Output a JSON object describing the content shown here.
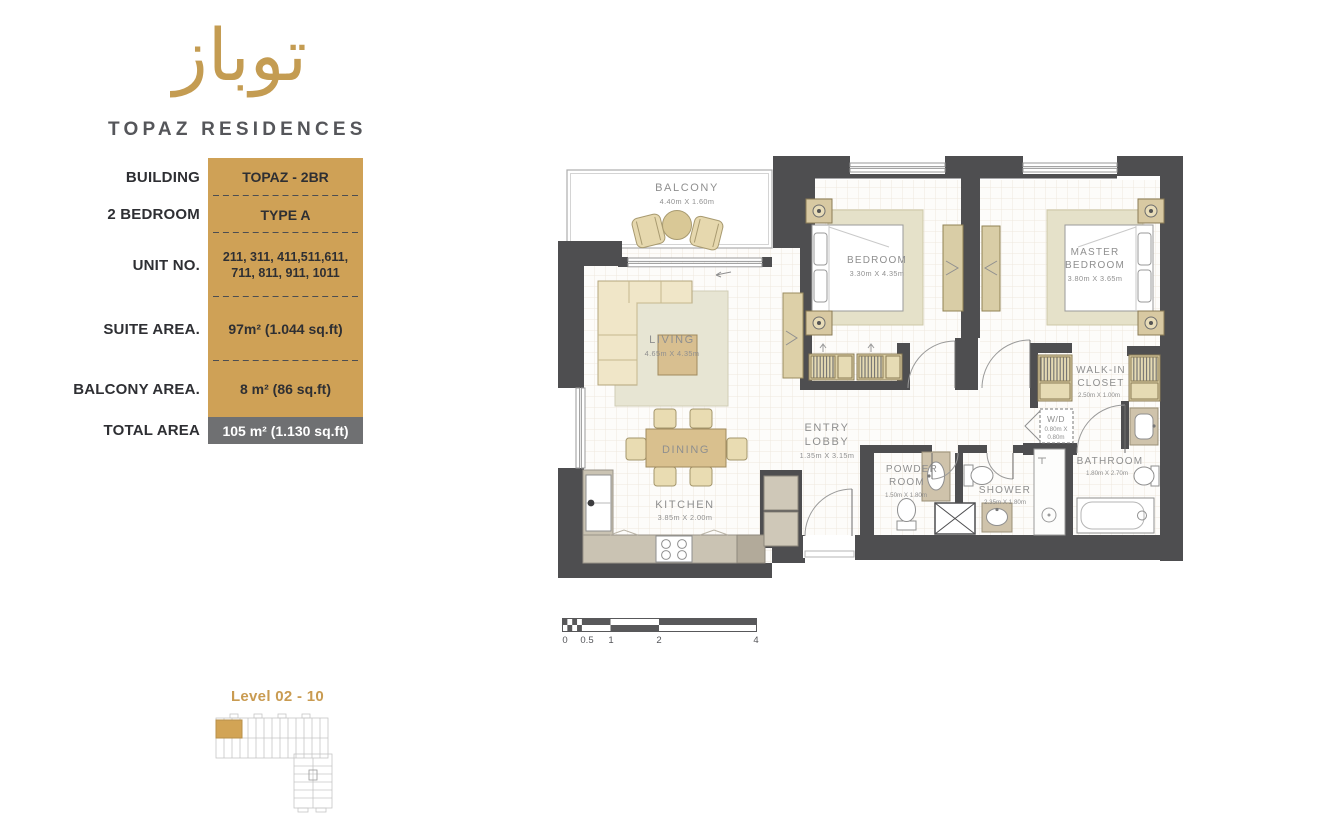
{
  "brand": {
    "logo_arabic": "توباز",
    "name": "TOPAZ RESIDENCES"
  },
  "specs": {
    "rows": [
      {
        "label": "BUILDING",
        "value": "TOPAZ - 2BR"
      },
      {
        "label": "2 BEDROOM",
        "value": "TYPE A"
      },
      {
        "label": "UNIT NO.",
        "value_lines": [
          "211, 311, 411,511,611,",
          "711, 811, 911, 1011"
        ]
      },
      {
        "label": "SUITE AREA.",
        "value": "97m² (1.044 sq.ft)"
      },
      {
        "label": "BALCONY AREA.",
        "value": "8 m² (86 sq.ft)"
      },
      {
        "label": "TOTAL AREA",
        "value": "105 m² (1.130 sq.ft)"
      }
    ]
  },
  "floor_plan": {
    "balcony": {
      "name": "BALCONY",
      "dims": "4.40m X 1.60m"
    },
    "living": {
      "name": "LIVING",
      "dims": "4.65m X 4.35m"
    },
    "dining": {
      "name": "DINING"
    },
    "kitchen": {
      "name": "KITCHEN",
      "dims": "3.85m X 2.00m"
    },
    "entry_lobby": {
      "name1": "ENTRY",
      "name2": "LOBBY",
      "dims": "1.35m X 3.15m"
    },
    "bedroom": {
      "name": "BEDROOM",
      "dims": "3.30m X 4.35m"
    },
    "master_bedroom": {
      "name1": "MASTER",
      "name2": "BEDROOM",
      "dims": "3.80m X 3.65m"
    },
    "walk_in_closet": {
      "name1": "WALK-IN",
      "name2": "CLOSET",
      "dims": "2.50m X 1.00m"
    },
    "wd": {
      "name": "W/D",
      "dims1": "0.80m X",
      "dims2": "0.80m"
    },
    "powder_room": {
      "name1": "POWDER",
      "name2": "ROOM",
      "dims": "1.50m X 1.80m"
    },
    "shower": {
      "name": "SHOWER",
      "dims": "2.35m X 1.80m"
    },
    "bathroom": {
      "name": "BATHROOM",
      "dims": "1.80m X 2.70m"
    }
  },
  "scale_bar": {
    "ticks": [
      "0",
      "0.5",
      "1",
      "2",
      "4"
    ]
  },
  "level": {
    "label": "Level 02 - 10"
  },
  "colors": {
    "gold": "#cfa156",
    "wall": "#4e4e50",
    "furniture_beige": "#ddd1a6",
    "counter": "#cac3b3",
    "total_row": "#6f7072",
    "label_gray": "#8f8f8f",
    "brand_text": "#55565a"
  }
}
